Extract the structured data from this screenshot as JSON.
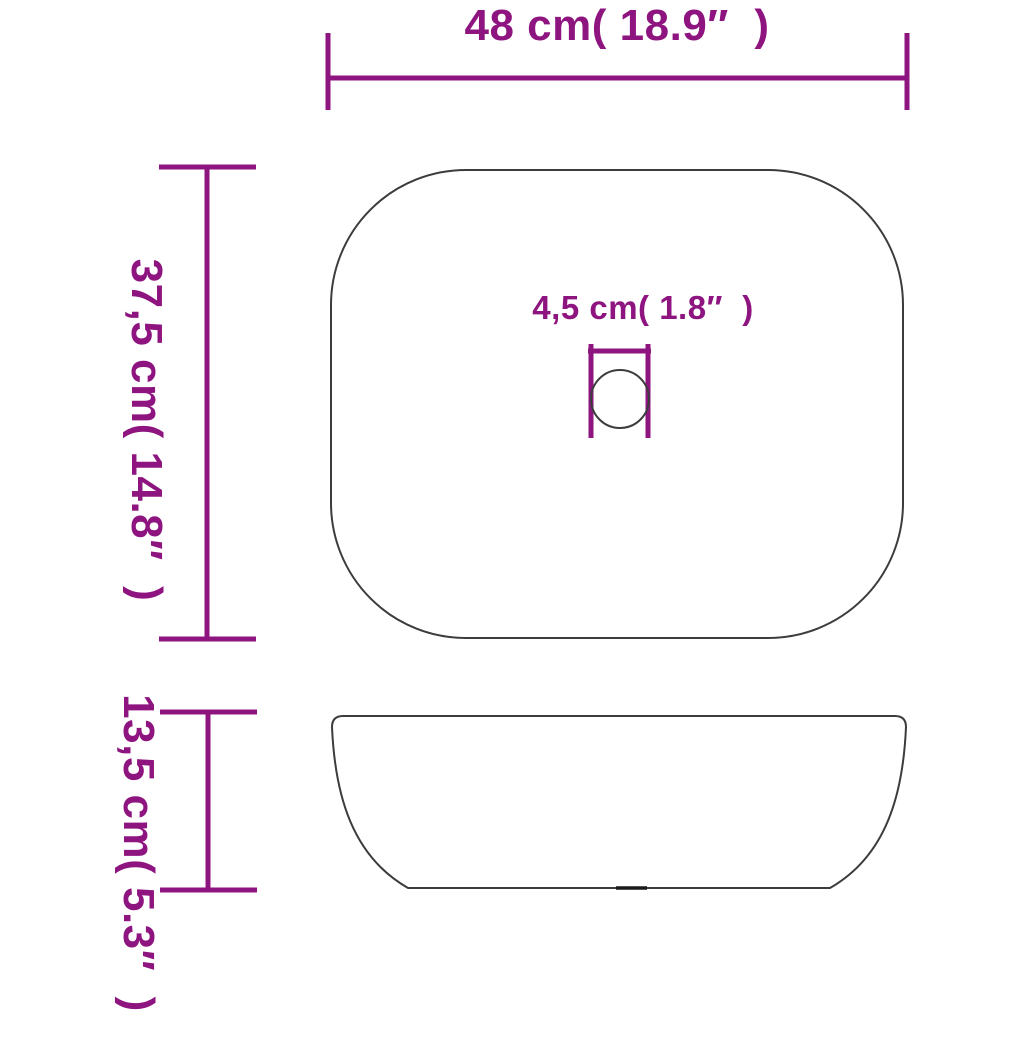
{
  "diagram": {
    "type": "product-dimension-diagram",
    "views": [
      "top-view",
      "side-view"
    ],
    "labels": {
      "width": "48 cm( 18.9″  )",
      "depth": "37,5 cm( 14.8″  )",
      "drain": "4,5 cm( 1.8″  )",
      "height": "13,5 cm( 5.3″  )"
    },
    "colors": {
      "dimension_lines": "#8E1480",
      "outline": "#3C3C3C",
      "background": "#FFFFFF"
    }
  }
}
